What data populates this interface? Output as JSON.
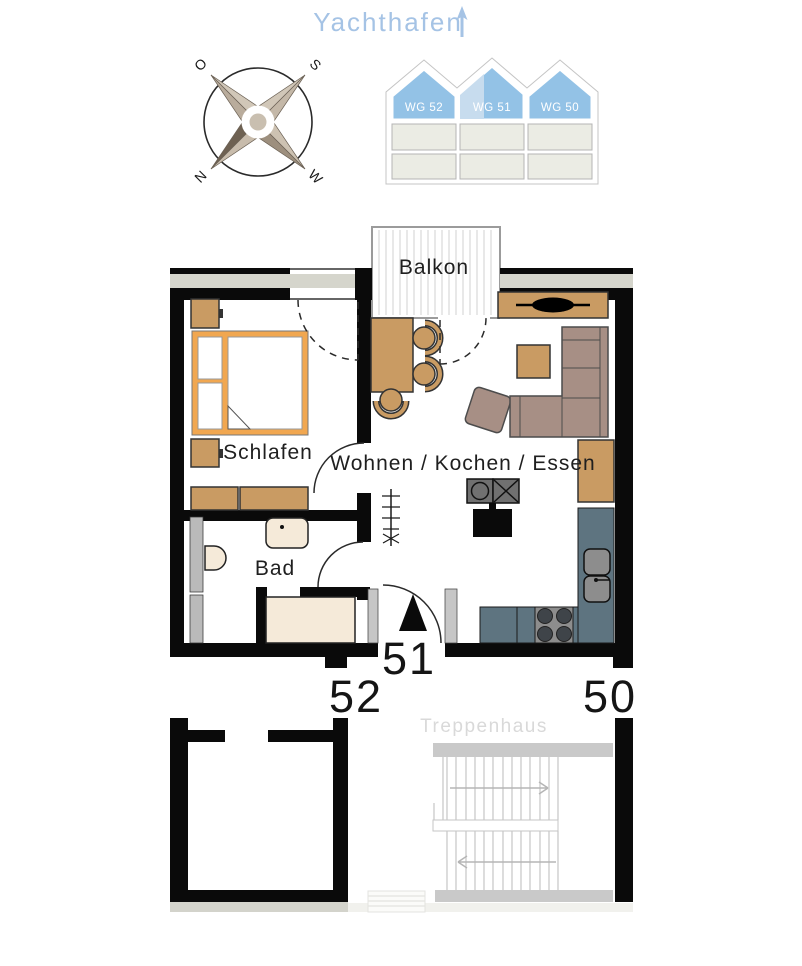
{
  "header": {
    "title": "Yachthafen"
  },
  "compass": {
    "o": "O",
    "s": "S",
    "n": "N",
    "w": "W"
  },
  "building": {
    "units": [
      {
        "label": "WG 52",
        "highlighted": false
      },
      {
        "label": "WG 51",
        "highlighted": true
      },
      {
        "label": "WG 50",
        "highlighted": false
      }
    ]
  },
  "plan": {
    "balcony": "Balkon",
    "bedroom": "Schlafen",
    "living": "Wohnen / Kochen / Essen",
    "bath": "Bad",
    "stairwell": "Treppenhaus",
    "unit_current": "51",
    "unit_left": "52",
    "unit_right": "50"
  },
  "colors": {
    "wall": "#0a0a0a",
    "wall_infill": "#d5d5cc",
    "accent_blue": "#a5c3e5",
    "building_blue": "#93c2e6",
    "building_blue_light": "#c7dcee",
    "wood": "#c99b63",
    "bed_frame": "#f1a750",
    "sofa": "#a78f85",
    "kitchen_counter": "#5e7480",
    "fixture_cream": "#f5ead9",
    "jamb_gray": "#c6c6c6",
    "stair_gray": "#c9c9c9",
    "label": "#1f1f1f",
    "faint_label": "#d9d9d9"
  }
}
